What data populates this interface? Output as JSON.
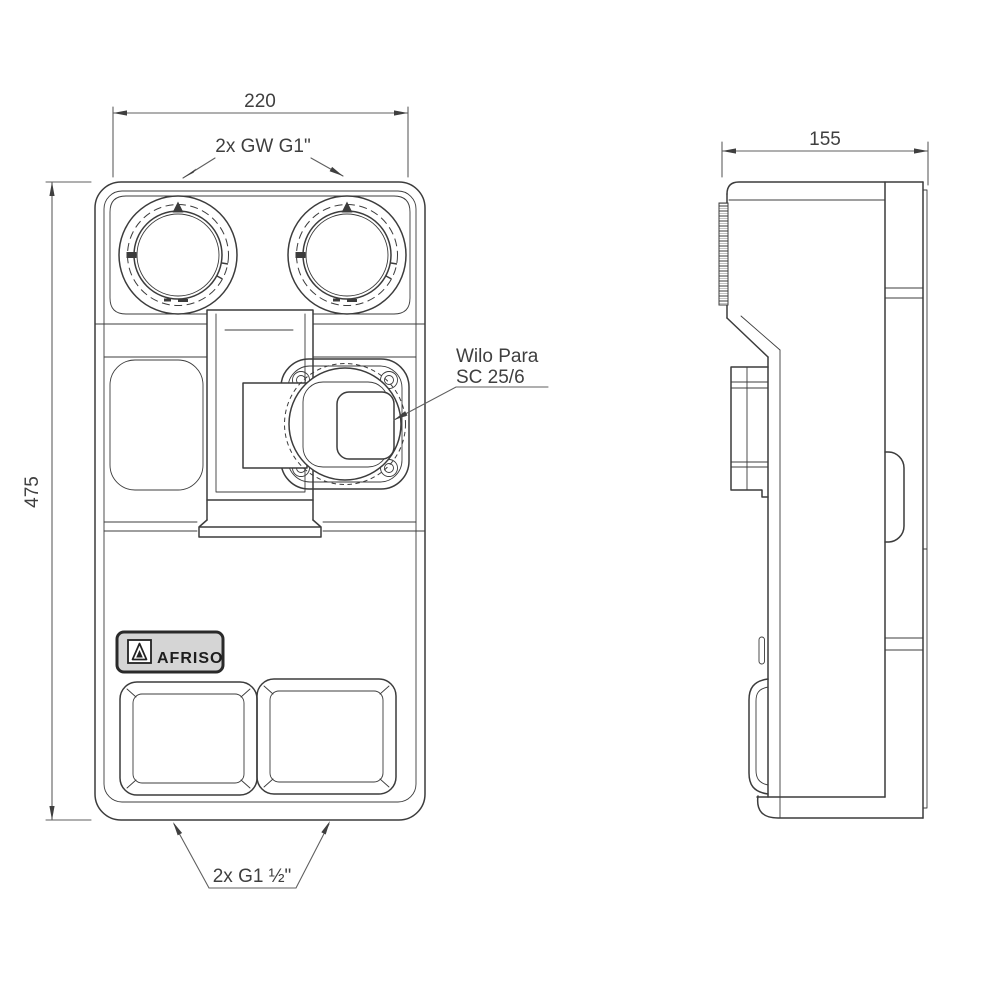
{
  "drawing": {
    "front_view": {
      "width_dim": "220",
      "height_dim": "475",
      "top_ports_label": "2x GW G1\"",
      "bottom_ports_label": "2x G1 ½\"",
      "pump_label_line1": "Wilo Para",
      "pump_label_line2": "SC 25/6",
      "brand_label": "AFRISO"
    },
    "side_view": {
      "depth_dim": "155"
    },
    "colors": {
      "line": "#3c3c3c",
      "dim_line": "#5f5f5f",
      "arrow": "#3f3f3f",
      "text": "#3f3f3f",
      "badge_fill": "#d5d5d5",
      "badge_border": "#2a2a2a"
    }
  }
}
